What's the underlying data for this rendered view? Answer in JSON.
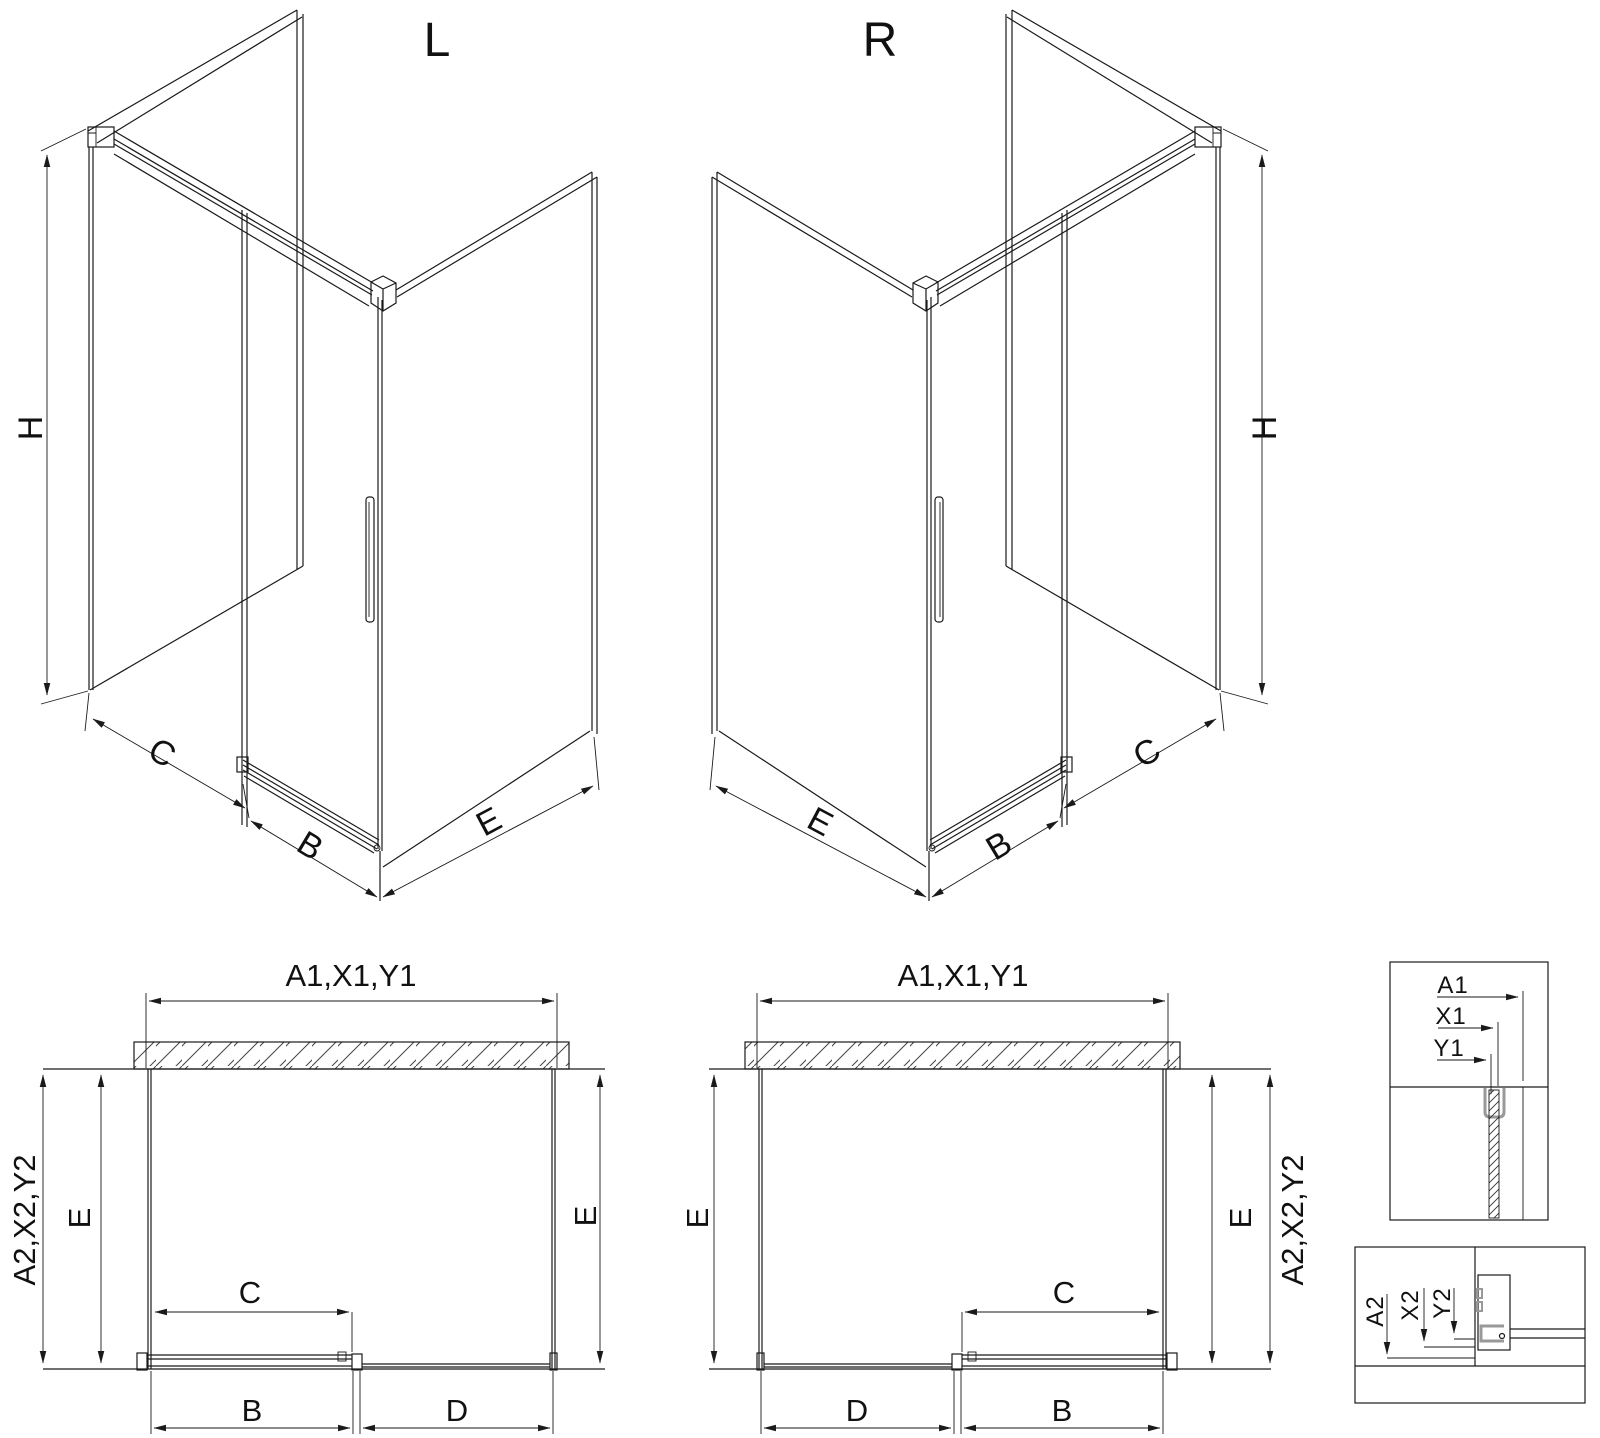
{
  "colors": {
    "line": "#1a1a1a",
    "gray": "#999999",
    "background": "#ffffff"
  },
  "iso_left": {
    "title": "L",
    "dim_h": "H",
    "dim_c": "C",
    "dim_b": "B",
    "dim_e": "E"
  },
  "iso_right": {
    "title": "R",
    "dim_h": "H",
    "dim_c": "C",
    "dim_b": "B",
    "dim_e": "E"
  },
  "plan_left": {
    "dim_top": "A1,X1,Y1",
    "dim_side": "A2,X2,Y2",
    "dim_e_left": "E",
    "dim_e_right": "E",
    "dim_c": "C",
    "dim_b": "B",
    "dim_d": "D"
  },
  "plan_mid": {
    "dim_top": "A1,X1,Y1",
    "dim_side": "A2,X2,Y2",
    "dim_e_left": "E",
    "dim_e_right": "E",
    "dim_c": "C",
    "dim_b": "B",
    "dim_d": "D"
  },
  "detail_wall": {
    "dim_a1": "A1",
    "dim_x1": "X1",
    "dim_y1": "Y1"
  },
  "detail_track": {
    "dim_a2": "A2",
    "dim_x2": "X2",
    "dim_y2": "Y2"
  }
}
